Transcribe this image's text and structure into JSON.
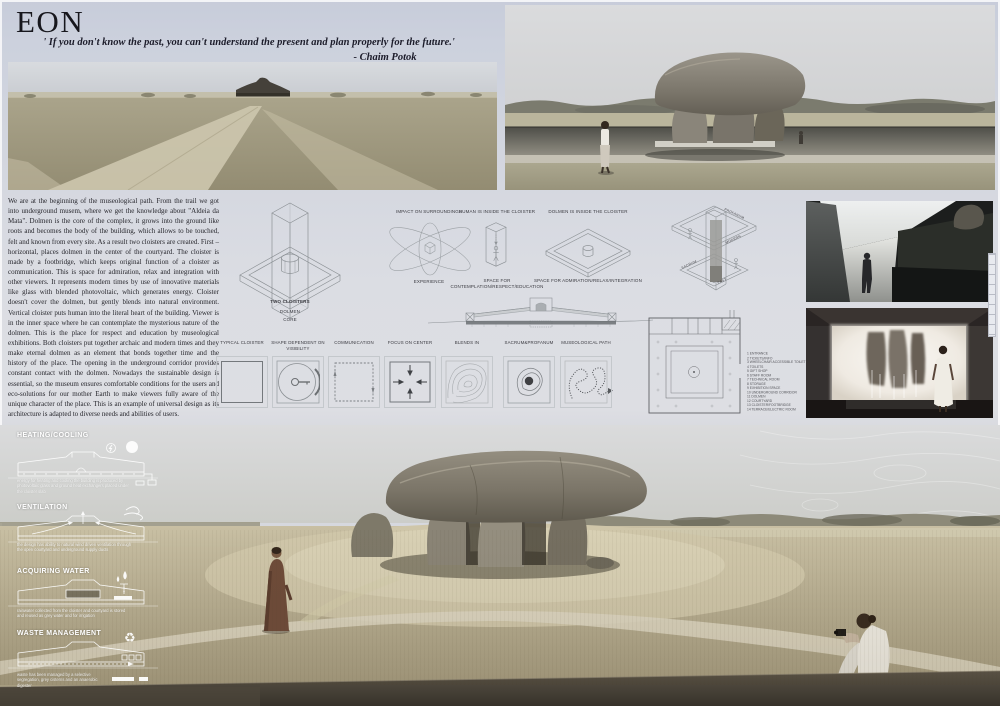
{
  "board": {
    "title": "EON",
    "quote": "' If you don't know the past, you can't understand the present and plan properly for the future.'",
    "quote_author": "- Chaim Potok",
    "code": "SC72647"
  },
  "essay": {
    "text": "We are at the beginning of the museological path. From the trail we got into underground musem, where we get the knowledge about \"Aldeia da Mata\". Dolmen is the core of the complex, it grows into the ground like roots and becomes the body of the building, which allows to be touched, felt and known from every site. As a result two cloisters are created. First – horizontal, places dolmen in the center of the courtyard. The cloister is made by a footbridge, which keeps original function of a cloister as communication. This is space for admiration, relax and integration with other viewers. It represents modern times by use of innovative materials like glass with blended photovoltaic, which generates energy. Cloister doesn't cover the dolmen, but gently blends into natural environment. Vertical cloister puts human into the literal heart of the building. Viewer is in the inner space where he can contemplate the mysterious nature of the dolmen. This is the place for respect and education by museological exhibitions. Both cloisters put together archaic and modern times and they make eternal dolmen as an element that bonds together time and the history of the place. The opening in the underground corridor provides constant contact with the dolmen. Nowadays the sustainable design is essential, so the museum ensures comfortable conditions for the users and eco-solutions for our mother Earth to make viewers fully aware of the unique character of the place. This is an example of universal design as its architecture is adapted to diverse needs and abilities of users."
  },
  "diagrams": {
    "axon_title": "TWO CLOISTERS",
    "axon_sub1": "DOLMEN",
    "axon_sub2": "CORE",
    "atom_top": "IMPACT ON SURROUNDINGS",
    "atom_bottom": "EXPERIENCE",
    "tower_top": "HUMAN IS INSIDE THE CLOISTER",
    "tower_caption": "SPACE FOR CONTEMPLATION/RESPECT/EDUCATION",
    "frame_top": "DOLMEN IS INSIDE THE CLOISTER",
    "frame_caption": "SPACE FOR ADMIRATION/RELAX/INTEGRATION",
    "cutaway": {
      "top": "PROFANUM",
      "right": "MODERN",
      "left": "SACRUM",
      "bottom": "PAST"
    }
  },
  "schemes": [
    {
      "label": "TYPICAL CLOISTER"
    },
    {
      "label": "SHAPE DEPENDENT ON VISIBILITY"
    },
    {
      "label": "COMMUNICATION"
    },
    {
      "label": "FOCUS ON CENTER"
    },
    {
      "label": "BLENDS IN"
    },
    {
      "label": "SACRUM&PROFANUM"
    },
    {
      "label": "MUSEOLOGICAL PATH"
    }
  ],
  "plan_legend": [
    "1 ENTRANCE",
    "2 TICKETS/INFO",
    "3 WHEELCHAIR ACCESSIBLE TOILET",
    "4 TOILETS",
    "5 GIFT SHOP",
    "6 STAFF ROOM",
    "7 TECHNICAL ROOM",
    "8 STORAGE",
    "9 EXHIBITION SPACE",
    "10 UNDERGROUND CORRIDOR",
    "11 DOLMEN",
    "12 COURTYARD",
    "13 CLOISTER/FOOTBRIDGE",
    "14 TERRACE/ELECTRIC ROOM"
  ],
  "systems": [
    {
      "title": "HEATING/COOLING",
      "caption": "energy for heating and cooling the building is produced by photovoltaic glass and ground heat exchangers placed under the cloister slab"
    },
    {
      "title": "VENTILATION",
      "caption": "the design has ability to natural wind driven ventilation through the open courtyard and underground supply ducts"
    },
    {
      "title": "ACQUIRING WATER",
      "caption": "rainwater collected from the cloister and courtyard is stored and reused as grey water and for irrigation"
    },
    {
      "title": "WASTE MANAGEMENT",
      "caption": "waste has been managed by a selective segregation, grey cisterns and an anaerobic digester"
    }
  ],
  "colors": {
    "board_bg": "#ccd1dc",
    "ink": "#1a1a22",
    "diagram_line": "#8d9296",
    "overlay_white": "#ffffff"
  }
}
